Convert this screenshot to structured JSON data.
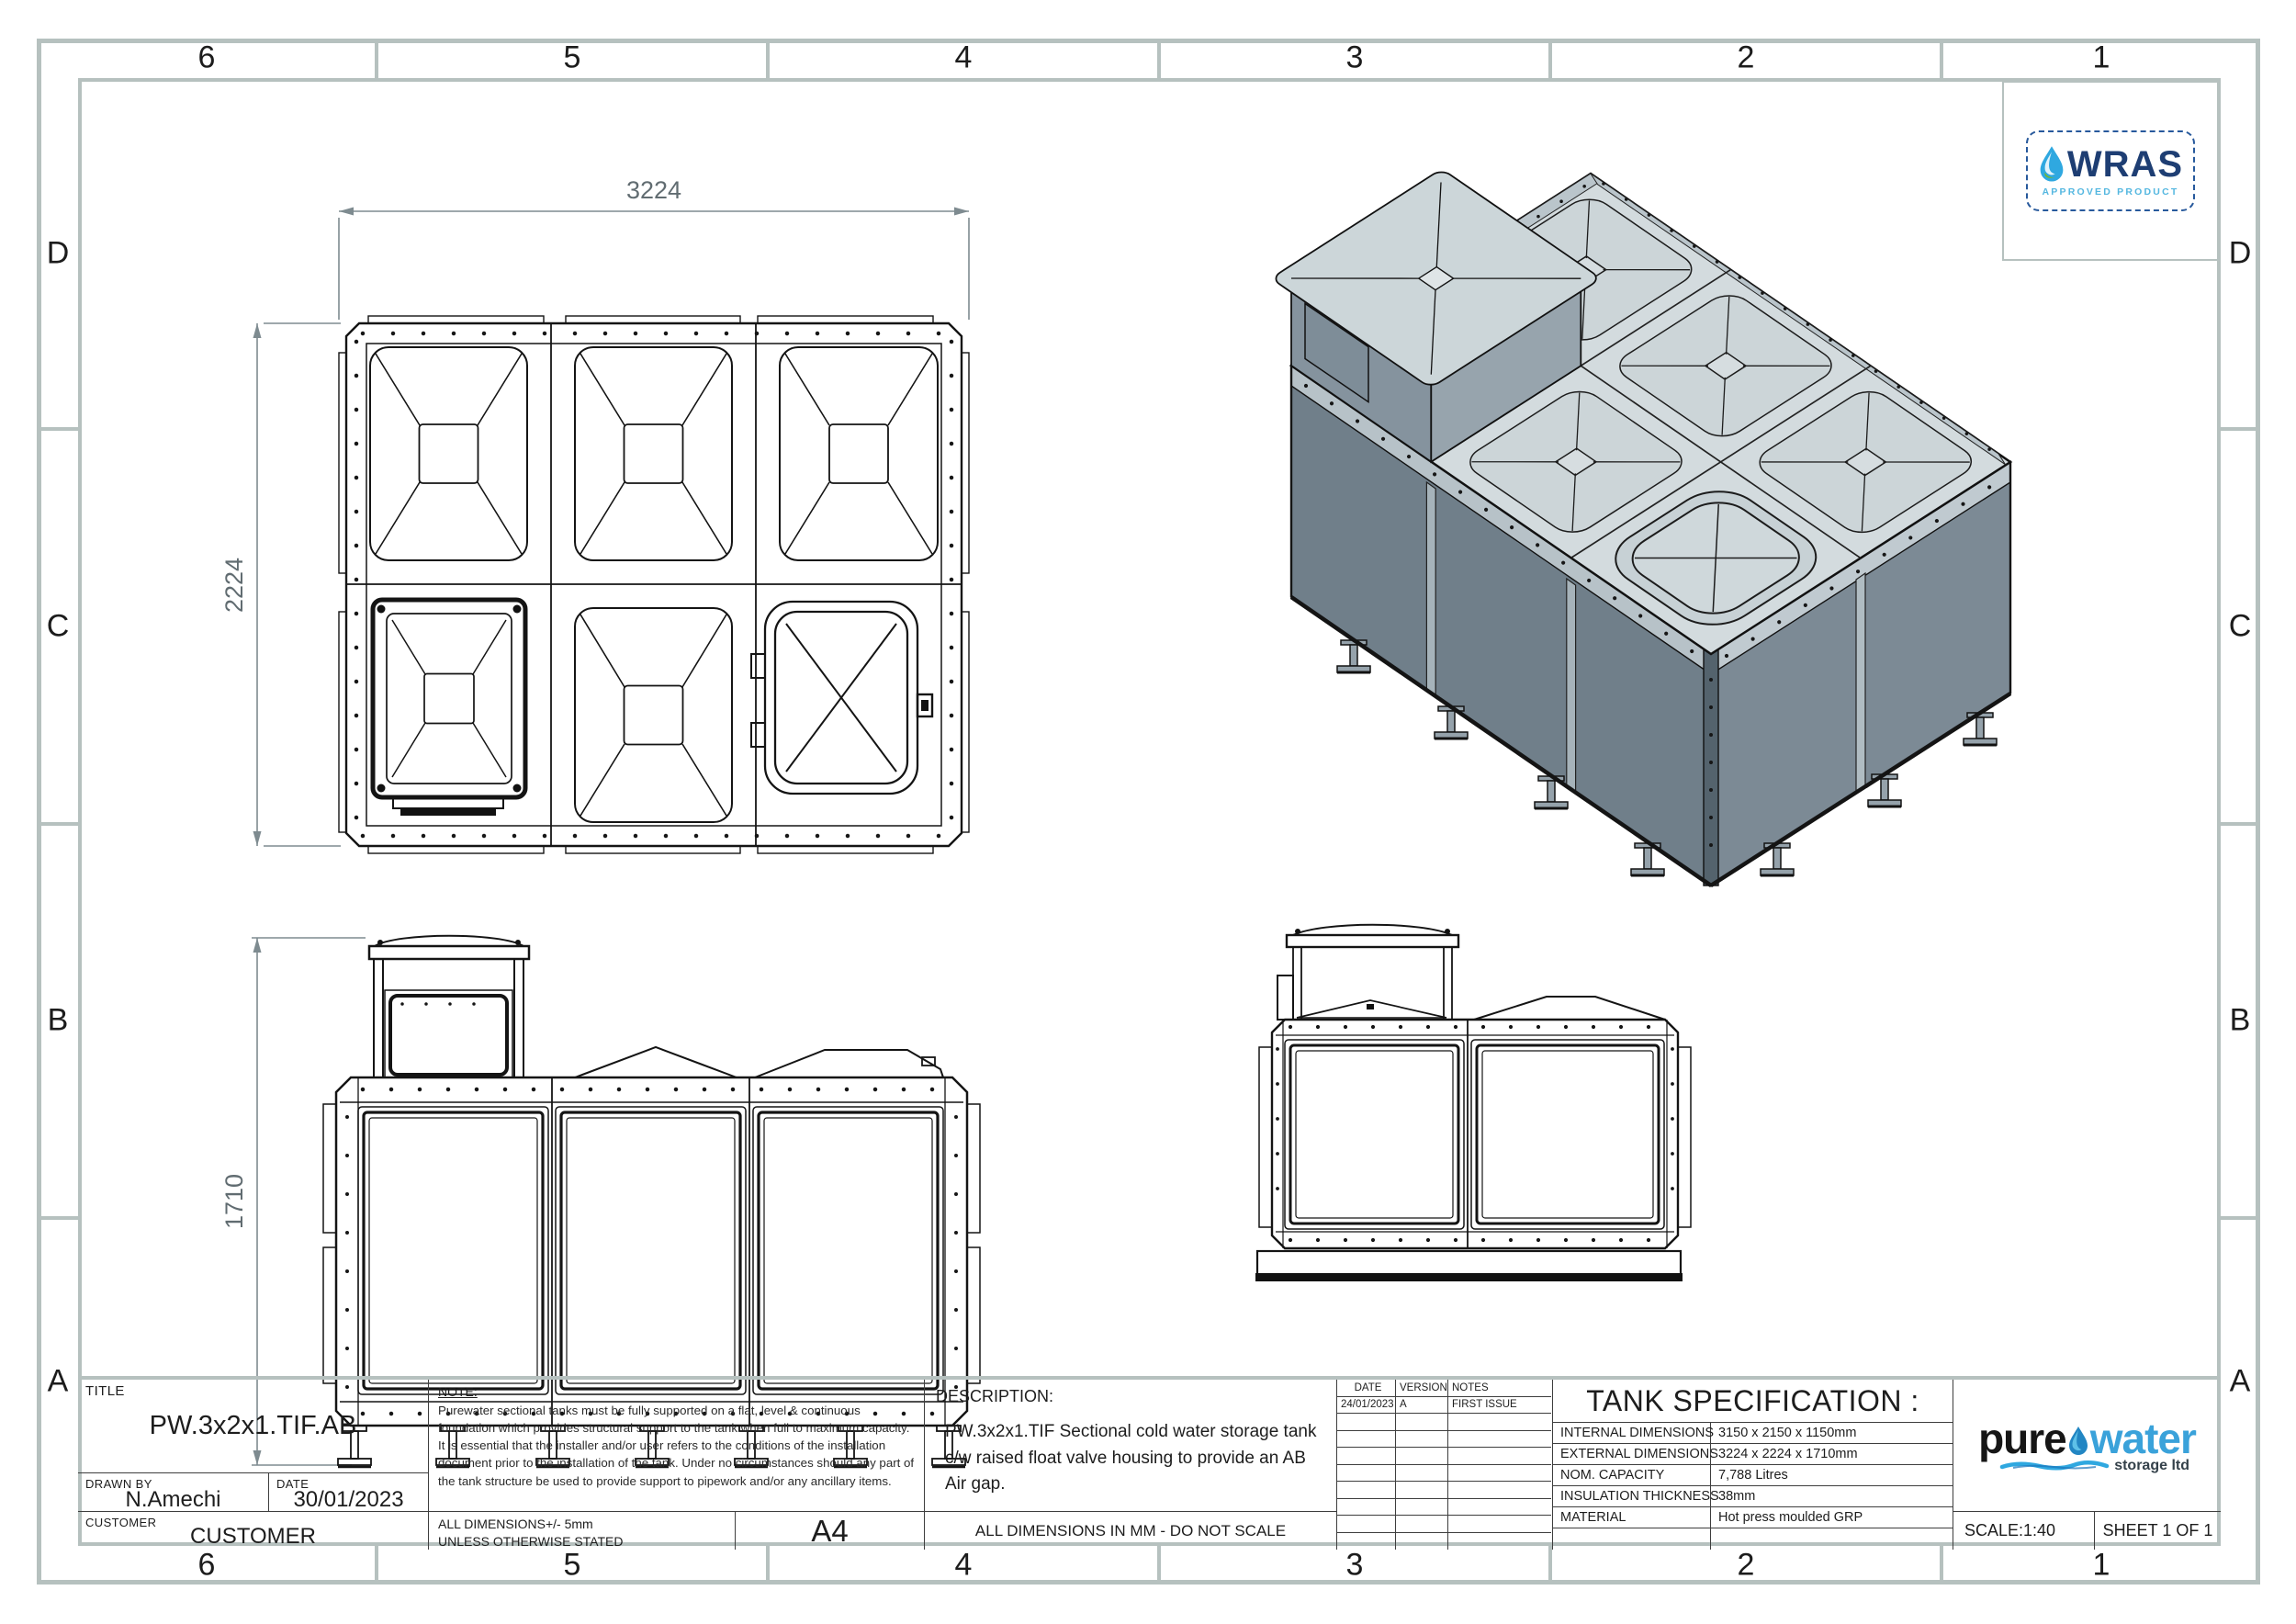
{
  "sheet": {
    "zones": {
      "cols": [
        "6",
        "5",
        "4",
        "3",
        "2",
        "1"
      ],
      "rows": [
        "D",
        "C",
        "B",
        "A"
      ]
    },
    "dimensions": {
      "plan_width": "3224",
      "plan_height": "2224",
      "front_height": "1710"
    },
    "wras": {
      "name": "WRAS",
      "subtitle": "APPROVED PRODUCT"
    },
    "title_block": {
      "title_label": "TITLE",
      "title": "PW.3x2x1.TIF.AB",
      "drawn_by_label": "DRAWN BY",
      "drawn_by": "N.Amechi",
      "date_label": "DATE",
      "date": "30/01/2023",
      "customer_label": "CUSTOMER",
      "customer": "CUSTOMER",
      "note_label": "NOTE:",
      "note_text": "Purewater sectional tanks must be fully supported on a flat, level & continuous foundation which provides structural support to the tank when full to maximum capacity. It is essential that the installer and/or user refers to the conditions of the installation document prior to the installation of the tank. Under no circumstances should any part of the tank structure be used to provide support to pipework and/or any ancillary items.",
      "tolerance_line1": "ALL DIMENSIONS+/- 5mm",
      "tolerance_line2": "UNLESS OTHERWISE STATED",
      "paper_size": "A4",
      "description_label": "DESCRIPTION:",
      "description_text": "PW.3x2x1.TIF Sectional cold water storage tank c/w raised float valve housing to provide an AB Air gap.",
      "dims_note": "ALL DIMENSIONS IN MM - DO NOT SCALE",
      "scale": "SCALE:1:40",
      "sheet_no": "SHEET 1 OF 1"
    },
    "revisions": {
      "headers": [
        "DATE",
        "VERSION",
        "NOTES"
      ],
      "rows": [
        [
          "24/01/2023",
          "A",
          "FIRST ISSUE"
        ]
      ]
    },
    "specification": {
      "title": "TANK SPECIFICATION :",
      "rows": [
        {
          "label": "INTERNAL DIMENSIONS",
          "value": "3150 x 2150 x 1150mm"
        },
        {
          "label": "EXTERNAL DIMENSIONS",
          "value": "3224 x 2224 x 1710mm"
        },
        {
          "label": "NOM. CAPACITY",
          "value": "7,788 Litres"
        },
        {
          "label": "INSULATION THICKNESS",
          "value": "38mm"
        },
        {
          "label": "MATERIAL",
          "value": "Hot press moulded GRP"
        }
      ]
    },
    "brand": {
      "word1": "pure",
      "word2": "water",
      "tagline": "storage ltd"
    }
  }
}
